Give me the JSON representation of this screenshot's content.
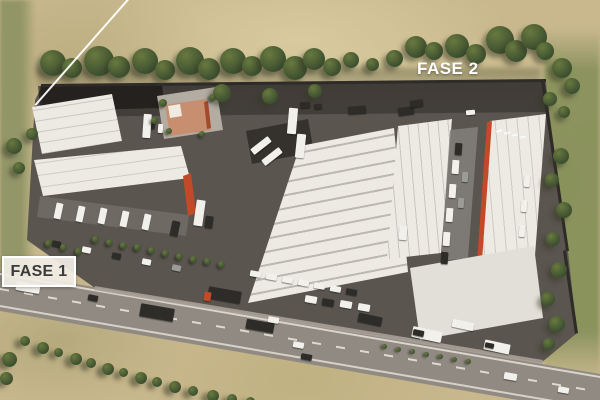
{
  "labels": {
    "fase1": "FASE 1",
    "fase2": "FASE 2"
  },
  "colors": {
    "field": "#c9b88e",
    "field_olive": "#8d9364",
    "grass": "#7c8a52",
    "tree_dark": "#3c4f2f",
    "tree_light": "#68793f",
    "pavement": "#5a554f",
    "pavement_dark": "#35322e",
    "road": "#908a82",
    "road_line": "#e7e3d9",
    "building": "#eceae3",
    "building_shade": "#c9c5bd",
    "accent": "#c24a28",
    "terracotta": "#c78e70",
    "plaza": "#b2aca3",
    "label_dark": "#3a3a3a",
    "label_box_bg": "rgba(242,238,230,0.92)",
    "white": "#ffffff"
  }
}
